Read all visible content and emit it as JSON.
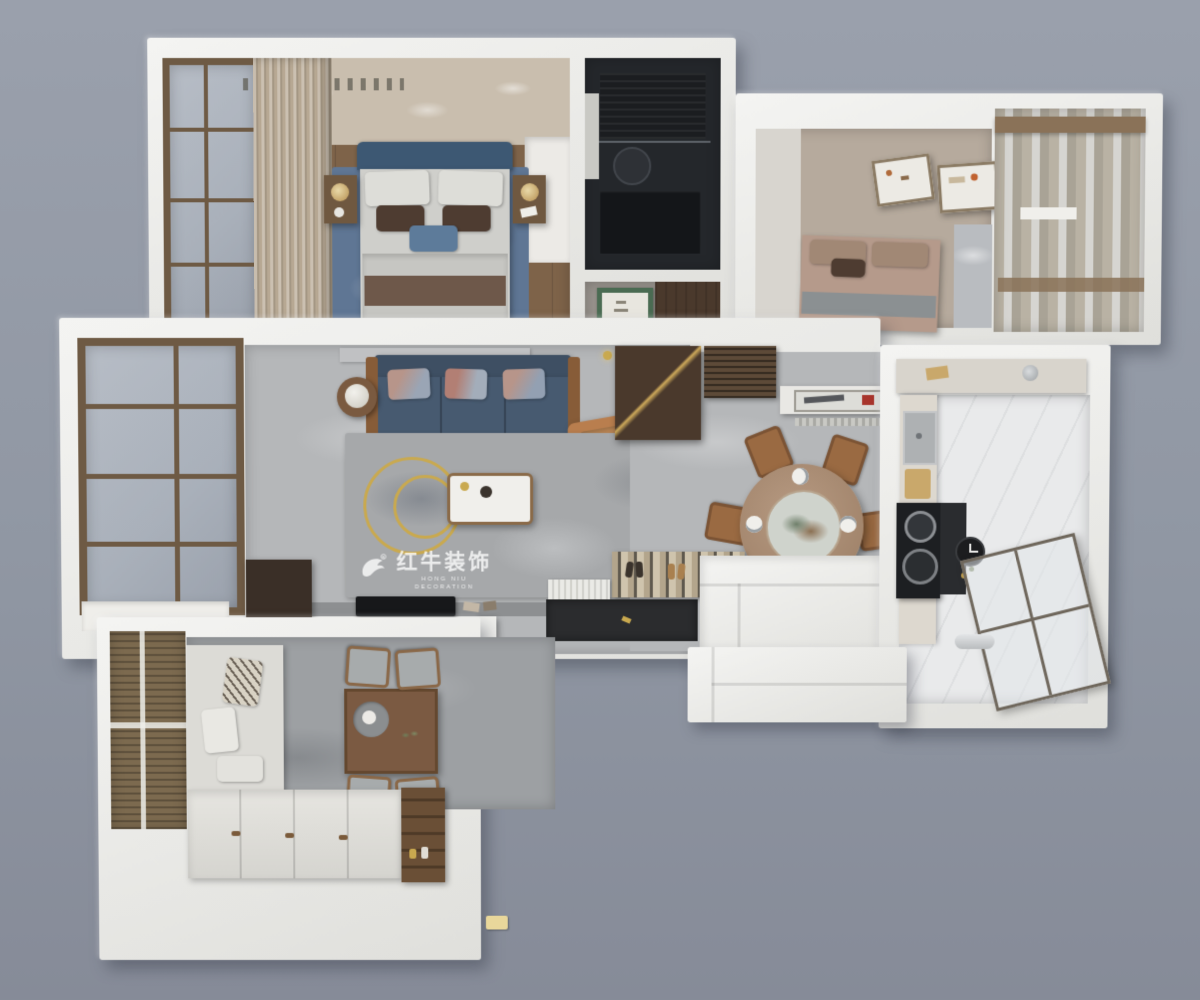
{
  "watermark": {
    "brand": "红牛装饰",
    "tagline": "HONG NIU DECORATION",
    "logo_icon": "bull-icon",
    "registered_mark": "®"
  },
  "colors": {
    "bg": "#9097a3",
    "bg_top": "#9aa0ac",
    "bg_bottom": "#868b98",
    "wall": "#f4f4f2",
    "wall_shade": "#dfdfdb",
    "floor_main": "#b5b7b9",
    "floor_study": "#9da0a3",
    "floor_kitchen": "#e9eaeb",
    "floor_hall": "#98938d",
    "wood": "#7e6349",
    "wood_mid": "#8a5f3e",
    "wood_dark": "#4a392c",
    "wallpaper": "#c9beae",
    "curtain": "#b7a893",
    "rug_master": "#5f7694",
    "rug_living": "#a6a8aa",
    "sofa": "#475a70",
    "sofa_dark": "#3e4f63",
    "armchair": "#b97e4e",
    "gold": "#c9a94f",
    "bath": "#24272b",
    "mat": "#2b2c2e",
    "bed2": "#b59a8b",
    "glass": "#a9b0ba",
    "blind": "#7c6a4f",
    "watermark": "rgba(255,255,255,0.78)"
  }
}
